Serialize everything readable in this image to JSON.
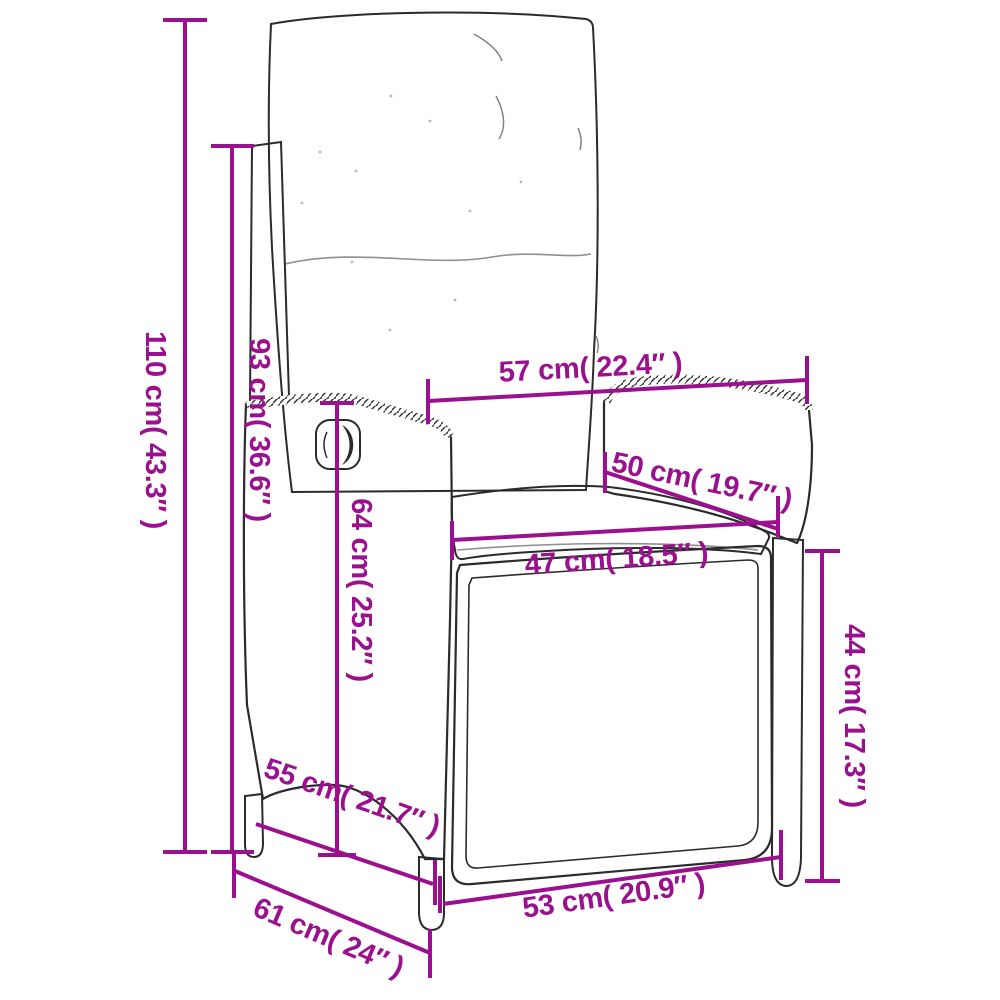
{
  "page": {
    "background": "#ffffff",
    "kind": "product dimension diagram",
    "subject": "reclining wicker garden chair with cushions, line drawing with measurements"
  },
  "style": {
    "dimension_color": "#9B108E",
    "drawing_color": "#2b2b2b"
  },
  "dimensions": [
    {
      "id": "overall-height",
      "label": "110 cm( 43.3″ )"
    },
    {
      "id": "backrest-height",
      "label": "93 cm( 36.6″ )"
    },
    {
      "id": "top-width",
      "label": "57 cm( 22.4″ )"
    },
    {
      "id": "backrest-width",
      "label": "50 cm( 19.7″ )"
    },
    {
      "id": "seat-width",
      "label": "47 cm( 18.5″ )"
    },
    {
      "id": "armrest-height",
      "label": "64 cm( 25.2″ )"
    },
    {
      "id": "seat-front-height",
      "label": "44 cm( 17.3″ )"
    },
    {
      "id": "side-seat-depth",
      "label": "55 cm( 21.7″ )"
    },
    {
      "id": "front-bottom-width",
      "label": "53 cm( 20.9″ )"
    },
    {
      "id": "overall-depth",
      "label": "61 cm( 24″ )"
    }
  ]
}
